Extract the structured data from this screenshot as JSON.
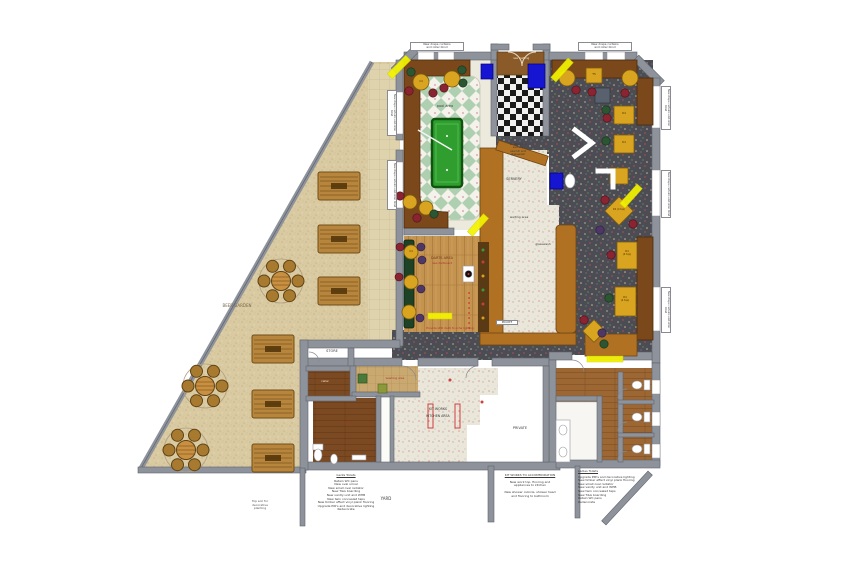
{
  "plan_title": "Public house refurbishment floor plan",
  "rooms": {
    "pool_area": "pool area",
    "servery": "SERVERY",
    "waiting_area": "waiting area",
    "glasswash": "glasswash",
    "darts_area": "DARTS AREA",
    "darts_sub": "new dartboard",
    "oche_note": "Provide LED multi fx oche lighting",
    "beer_garden": "BEER GARDEN",
    "store": "STORE",
    "yard": "YARD",
    "private_room": "PRIVATE",
    "private_door": "PRIVATE",
    "kitchen_line1": "KIT WORKS",
    "kitchen_line2": "KITCHEN AREA",
    "matting": "new matting",
    "washing_area": "washing area",
    "cellar": "cellar",
    "gents_wc": "W.C.",
    "bar_note": "existing bar\nservery\nnew till and\nglasswash"
  },
  "window_labels": {
    "top_pool": "New drape curtains\nand roller blind",
    "top_lounge": "New drape curtains\nand roller blind",
    "side": "New drape curtains and roller blind"
  },
  "tables": {
    "t5": "T5",
    "d4": "D4",
    "d4_top": "D4\n(4 top)",
    "d4_diamond": "D4 (4 top)",
    "c4": "C4"
  },
  "notes": {
    "gents": {
      "title": "Gents Toilets",
      "body": "Retain WC pans\nNew oval urinal\nNew small oval radiator\nNew T&G boarding\nNew vanity unit and WHB\nNew twin concealed taps\nNew timber effect vinyl plank flooring\nUpgrade PIR's and decorative lighting\nRedecorate"
    },
    "kit": {
      "title": "KIT WORKS TO ACCOMMODATION",
      "body": "New work top, flooring and\nappliances to kitchen\n\nNew shower cubicle, shower head\nand flooring to bathroom"
    },
    "ladies": {
      "title": "Ladies Toilets",
      "body": "Upgrade PIR's and decorative lighting\nNew timber effect vinyl plank flooring\nNew small oval radiator\nNew vanity unit and WHB\nNew twin concealed taps\nNew T&G boarding\nRetain WC pans\nRedecorate"
    },
    "garden": "Top soil for\ndecorative\nplanting"
  },
  "colors": {
    "highlight_marker": "#f4f400",
    "carpet": "#4c4c55",
    "garden_ground": "#d9caa2",
    "pool_tile_green": "#aed0b0",
    "booth_brown": "#7a481b",
    "bar_brown": "#b07123",
    "pool_table_green": "#2f9e2f",
    "machine_blue": "#1616d2"
  }
}
